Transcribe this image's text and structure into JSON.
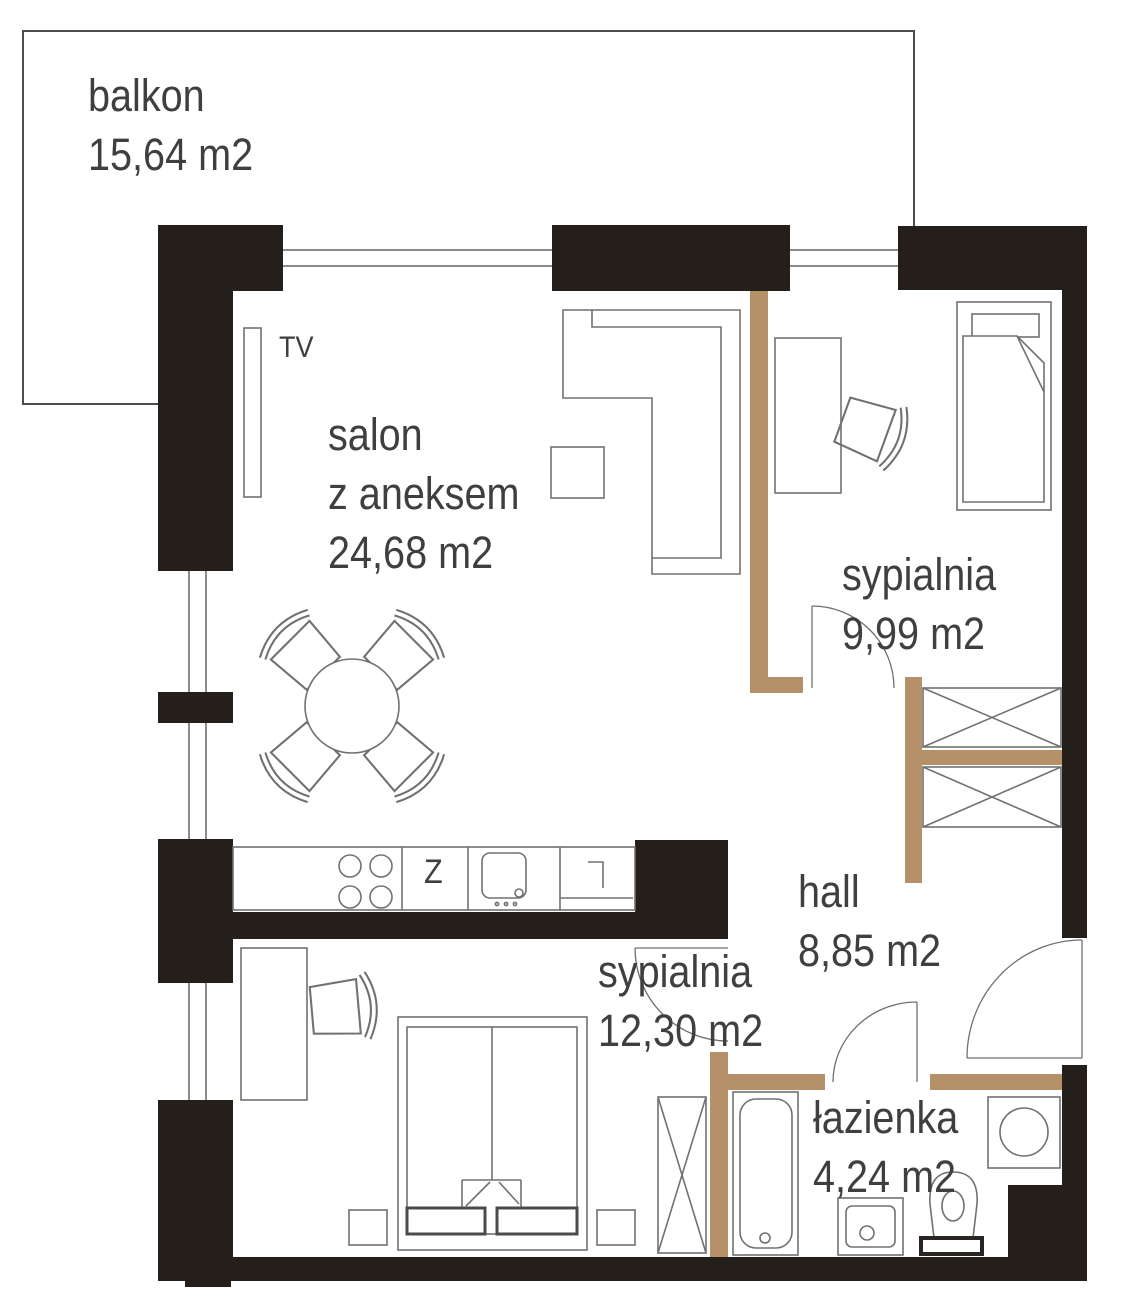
{
  "plan": {
    "title": "apartment floor plan",
    "rooms": [
      {
        "id": "balkon",
        "name": "balkon",
        "area": "15,64 m2"
      },
      {
        "id": "salon",
        "name": "salon",
        "name_line2": "z aneksem",
        "area": "24,68 m2"
      },
      {
        "id": "sypialnia-1",
        "name": "sypialnia",
        "area": "9,99 m2"
      },
      {
        "id": "hall",
        "name": "hall",
        "area": "8,85 m2"
      },
      {
        "id": "sypialnia-2",
        "name": "sypialnia",
        "area": "12,30 m2"
      },
      {
        "id": "lazienka",
        "name": "łazienka",
        "area": "4,24 m2"
      }
    ],
    "annotations": {
      "tv": "TV",
      "kitchen_sink": "Z"
    },
    "colors": {
      "wall": "#241f1a",
      "partition_wood": "#b59169",
      "furniture_line": "#71716f",
      "text": "#3f3f3d",
      "balcony_border": "#4c4c4a"
    }
  }
}
